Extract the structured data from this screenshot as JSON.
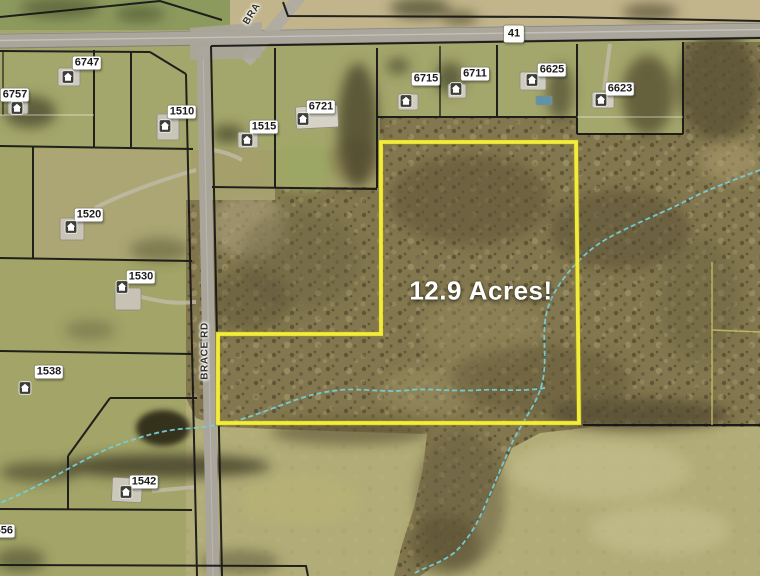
{
  "map": {
    "acreage_text": "12.9 Acres!",
    "highway_shield": "41",
    "road_labels": {
      "vertical": "BRACE RD",
      "top_partial": "BRA"
    },
    "edge_partial_address": "556",
    "addresses": [
      {
        "text": "6747",
        "x": 87,
        "y": 63
      },
      {
        "text": "6757",
        "x": 15,
        "y": 95
      },
      {
        "text": "1510",
        "x": 182,
        "y": 112
      },
      {
        "text": "1515",
        "x": 264,
        "y": 127
      },
      {
        "text": "6721",
        "x": 321,
        "y": 107
      },
      {
        "text": "6715",
        "x": 426,
        "y": 79
      },
      {
        "text": "6711",
        "x": 475,
        "y": 74
      },
      {
        "text": "6625",
        "x": 552,
        "y": 70
      },
      {
        "text": "6623",
        "x": 620,
        "y": 89
      },
      {
        "text": "1520",
        "x": 89,
        "y": 215
      },
      {
        "text": "1530",
        "x": 141,
        "y": 277
      },
      {
        "text": "1538",
        "x": 49,
        "y": 372
      },
      {
        "text": "1542",
        "x": 144,
        "y": 482
      }
    ],
    "houses": [
      {
        "x": 68,
        "y": 77
      },
      {
        "x": 17,
        "y": 108
      },
      {
        "x": 165,
        "y": 126
      },
      {
        "x": 247,
        "y": 140
      },
      {
        "x": 303,
        "y": 119
      },
      {
        "x": 406,
        "y": 101
      },
      {
        "x": 456,
        "y": 89
      },
      {
        "x": 532,
        "y": 80
      },
      {
        "x": 601,
        "y": 100
      },
      {
        "x": 71,
        "y": 227
      },
      {
        "x": 122,
        "y": 287
      },
      {
        "x": 25,
        "y": 388
      },
      {
        "x": 126,
        "y": 492
      }
    ],
    "colors": {
      "boundary_yellow": "#f3ec3c",
      "stream_cyan": "#74cfd8",
      "parcel_line": "#151515",
      "label_bg": "#ffffff",
      "label_text": "#1c1c1c",
      "road_gray": "#aaa69c",
      "acreage_text_color": "#ffffff"
    }
  }
}
